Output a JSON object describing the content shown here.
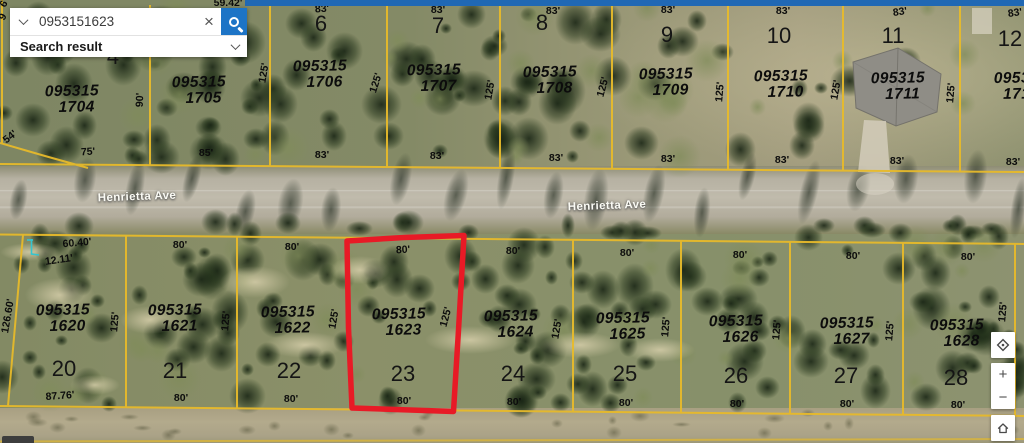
{
  "search": {
    "value": "0953151623",
    "placeholder": "Find address or place",
    "result_label": "Search result",
    "clear_glyph": "×"
  },
  "controls": {
    "zoom_in_label": "+",
    "zoom_out_label": "−"
  },
  "map": {
    "road_labels": [
      {
        "t": "Henrietta Ave",
        "x": 137,
        "y": 197,
        "r": -2
      },
      {
        "t": "Henrietta Ave",
        "x": 607,
        "y": 206,
        "r": -2
      }
    ],
    "parcel_labels": [
      {
        "l1": "095315",
        "l2": "1704",
        "x": 72,
        "y": 100
      },
      {
        "l1": "095315",
        "l2": "1705",
        "x": 199,
        "y": 91
      },
      {
        "l1": "095315",
        "l2": "1706",
        "x": 320,
        "y": 75
      },
      {
        "l1": "095315",
        "l2": "1707",
        "x": 434,
        "y": 79
      },
      {
        "l1": "095315",
        "l2": "1708",
        "x": 550,
        "y": 81
      },
      {
        "l1": "095315",
        "l2": "1709",
        "x": 666,
        "y": 83
      },
      {
        "l1": "095315",
        "l2": "1710",
        "x": 781,
        "y": 85
      },
      {
        "l1": "095315",
        "l2": "1711",
        "x": 898,
        "y": 87
      },
      {
        "l1": "0953",
        "l2": "171",
        "x": 1012,
        "y": 87
      },
      {
        "l1": "095315",
        "l2": "1620",
        "x": 63,
        "y": 319
      },
      {
        "l1": "095315",
        "l2": "1621",
        "x": 175,
        "y": 319
      },
      {
        "l1": "095315",
        "l2": "1622",
        "x": 288,
        "y": 321
      },
      {
        "l1": "095315",
        "l2": "1623",
        "x": 399,
        "y": 323
      },
      {
        "l1": "095315",
        "l2": "1624",
        "x": 511,
        "y": 325
      },
      {
        "l1": "095315",
        "l2": "1625",
        "x": 623,
        "y": 327
      },
      {
        "l1": "095315",
        "l2": "1626",
        "x": 736,
        "y": 330
      },
      {
        "l1": "095315",
        "l2": "1627",
        "x": 847,
        "y": 332
      },
      {
        "l1": "095315",
        "l2": "1628",
        "x": 957,
        "y": 334
      }
    ],
    "lot_numbers": [
      {
        "t": "4",
        "x": 113,
        "y": 57
      },
      {
        "t": "6",
        "x": 321,
        "y": 24
      },
      {
        "t": "7",
        "x": 438,
        "y": 26
      },
      {
        "t": "8",
        "x": 542,
        "y": 23
      },
      {
        "t": "9",
        "x": 667,
        "y": 35
      },
      {
        "t": "10",
        "x": 779,
        "y": 36
      },
      {
        "t": "11",
        "x": 893,
        "y": 36
      },
      {
        "t": "12",
        "x": 1010,
        "y": 39
      },
      {
        "t": "20",
        "x": 64,
        "y": 369
      },
      {
        "t": "21",
        "x": 175,
        "y": 371
      },
      {
        "t": "22",
        "x": 289,
        "y": 371
      },
      {
        "t": "23",
        "x": 403,
        "y": 374
      },
      {
        "t": "24",
        "x": 513,
        "y": 374
      },
      {
        "t": "25",
        "x": 625,
        "y": 374
      },
      {
        "t": "26",
        "x": 736,
        "y": 376
      },
      {
        "t": "27",
        "x": 846,
        "y": 376
      },
      {
        "t": "28",
        "x": 956,
        "y": 378
      }
    ],
    "dimension_labels": [
      {
        "t": "6",
        "x": 4,
        "y": 4,
        "r": -60
      },
      {
        "t": "9",
        "x": 3,
        "y": 17,
        "r": -60
      },
      {
        "t": "59.42'",
        "x": 228,
        "y": 3,
        "r": 0
      },
      {
        "t": "83'",
        "x": 322,
        "y": 9,
        "r": -4
      },
      {
        "t": "83'",
        "x": 438,
        "y": 10,
        "r": 0
      },
      {
        "t": "83'",
        "x": 553,
        "y": 11,
        "r": 0
      },
      {
        "t": "83'",
        "x": 668,
        "y": 10,
        "r": 0
      },
      {
        "t": "83'",
        "x": 783,
        "y": 11,
        "r": 0
      },
      {
        "t": "83'",
        "x": 900,
        "y": 12,
        "r": -8
      },
      {
        "t": "83'",
        "x": 1015,
        "y": 13,
        "r": -8
      },
      {
        "t": "54'",
        "x": 10,
        "y": 137,
        "r": -38
      },
      {
        "t": "90'",
        "x": 140,
        "y": 100,
        "r": -88
      },
      {
        "t": "125'",
        "x": 264,
        "y": 73,
        "r": -80
      },
      {
        "t": "125'",
        "x": 376,
        "y": 83,
        "r": -72
      },
      {
        "t": "125'",
        "x": 490,
        "y": 90,
        "r": -80
      },
      {
        "t": "125'",
        "x": 603,
        "y": 87,
        "r": -75
      },
      {
        "t": "125'",
        "x": 720,
        "y": 92,
        "r": -85
      },
      {
        "t": "125'",
        "x": 836,
        "y": 90,
        "r": -80
      },
      {
        "t": "125'",
        "x": 951,
        "y": 93,
        "r": -85
      },
      {
        "t": "75'",
        "x": 88,
        "y": 152,
        "r": -3
      },
      {
        "t": "85'",
        "x": 206,
        "y": 153,
        "r": 0
      },
      {
        "t": "83'",
        "x": 322,
        "y": 155,
        "r": 0
      },
      {
        "t": "83'",
        "x": 437,
        "y": 156,
        "r": 0
      },
      {
        "t": "83'",
        "x": 556,
        "y": 158,
        "r": 0
      },
      {
        "t": "83'",
        "x": 668,
        "y": 159,
        "r": 0
      },
      {
        "t": "83'",
        "x": 782,
        "y": 160,
        "r": 0
      },
      {
        "t": "83'",
        "x": 897,
        "y": 161,
        "r": 0
      },
      {
        "t": "83'",
        "x": 1013,
        "y": 162,
        "r": 0
      },
      {
        "t": "60.40'",
        "x": 77,
        "y": 243,
        "r": -5
      },
      {
        "t": "12.11'",
        "x": 59,
        "y": 260,
        "r": -8
      },
      {
        "t": "80'",
        "x": 180,
        "y": 245,
        "r": 0
      },
      {
        "t": "80'",
        "x": 292,
        "y": 247,
        "r": 0
      },
      {
        "t": "80'",
        "x": 403,
        "y": 250,
        "r": -3
      },
      {
        "t": "80'",
        "x": 513,
        "y": 251,
        "r": 0
      },
      {
        "t": "80'",
        "x": 627,
        "y": 253,
        "r": 0
      },
      {
        "t": "80'",
        "x": 740,
        "y": 255,
        "r": 0
      },
      {
        "t": "80'",
        "x": 853,
        "y": 256,
        "r": 0
      },
      {
        "t": "80'",
        "x": 968,
        "y": 257,
        "r": 0
      },
      {
        "t": "126.60'",
        "x": 8,
        "y": 316,
        "r": -80
      },
      {
        "t": "125'",
        "x": 115,
        "y": 322,
        "r": -85
      },
      {
        "t": "125'",
        "x": 226,
        "y": 321,
        "r": -85
      },
      {
        "t": "125'",
        "x": 334,
        "y": 319,
        "r": -80
      },
      {
        "t": "125'",
        "x": 446,
        "y": 317,
        "r": -75
      },
      {
        "t": "125'",
        "x": 557,
        "y": 329,
        "r": -80
      },
      {
        "t": "125'",
        "x": 666,
        "y": 327,
        "r": -85
      },
      {
        "t": "125'",
        "x": 777,
        "y": 330,
        "r": -85
      },
      {
        "t": "125'",
        "x": 890,
        "y": 331,
        "r": -85
      },
      {
        "t": "125'",
        "x": 1003,
        "y": 312,
        "r": -85
      },
      {
        "t": "87.76'",
        "x": 60,
        "y": 396,
        "r": -4
      },
      {
        "t": "80'",
        "x": 181,
        "y": 398,
        "r": 0
      },
      {
        "t": "80'",
        "x": 291,
        "y": 399,
        "r": 0
      },
      {
        "t": "80'",
        "x": 404,
        "y": 401,
        "r": 0
      },
      {
        "t": "80'",
        "x": 514,
        "y": 402,
        "r": 0
      },
      {
        "t": "80'",
        "x": 626,
        "y": 403,
        "r": 0
      },
      {
        "t": "80'",
        "x": 737,
        "y": 404,
        "r": 0
      },
      {
        "t": "80'",
        "x": 847,
        "y": 404,
        "r": 0
      },
      {
        "t": "80'",
        "x": 958,
        "y": 405,
        "r": 0
      }
    ],
    "colors": {
      "parcel_line": "#e7ba2b",
      "highlight": "#e81a26",
      "search_button": "#1d74c6",
      "top_bar": "#2068b4",
      "marker": "#35c4cf"
    }
  }
}
